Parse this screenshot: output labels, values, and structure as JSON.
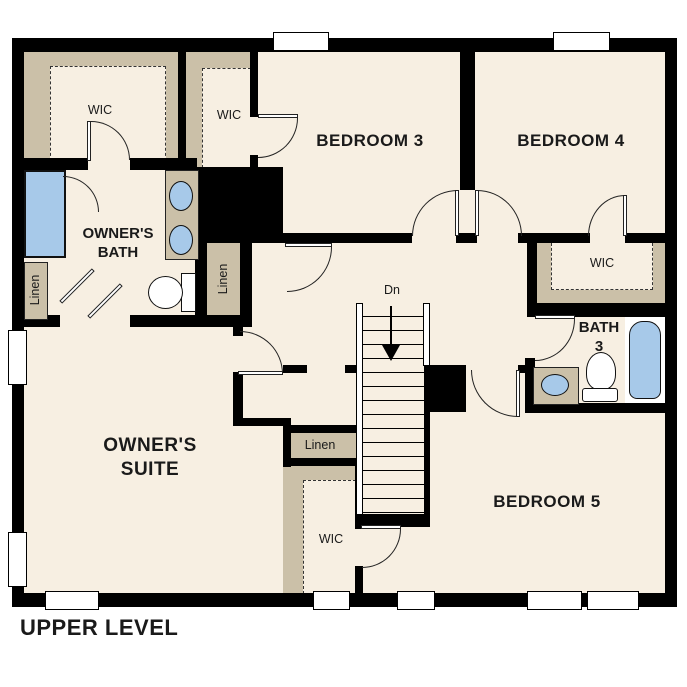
{
  "title": "UPPER LEVEL",
  "colors": {
    "floor": "#f7efe2",
    "closet_tan": "#cbc0a8",
    "fixture_blue": "#a7c9e9",
    "wall_black": "#000000",
    "text": "#1a1a1a"
  },
  "rooms": {
    "owners_suite": {
      "line1": "OWNER'S",
      "line2": "SUITE"
    },
    "owners_bath": {
      "line1": "OWNER'S",
      "line2": "BATH"
    },
    "bedroom3": {
      "label": "BEDROOM 3"
    },
    "bedroom4": {
      "label": "BEDROOM 4"
    },
    "bedroom5": {
      "label": "BEDROOM 5"
    },
    "bath3": {
      "line1": "BATH",
      "line2": "3"
    }
  },
  "closets": {
    "wic": "WIC",
    "linen": "Linen"
  },
  "stairs": {
    "down_label": "Dn"
  },
  "fixtures": {
    "shower": "shower",
    "tub": "bathtub",
    "toilet": "toilet",
    "sink": "sink"
  }
}
